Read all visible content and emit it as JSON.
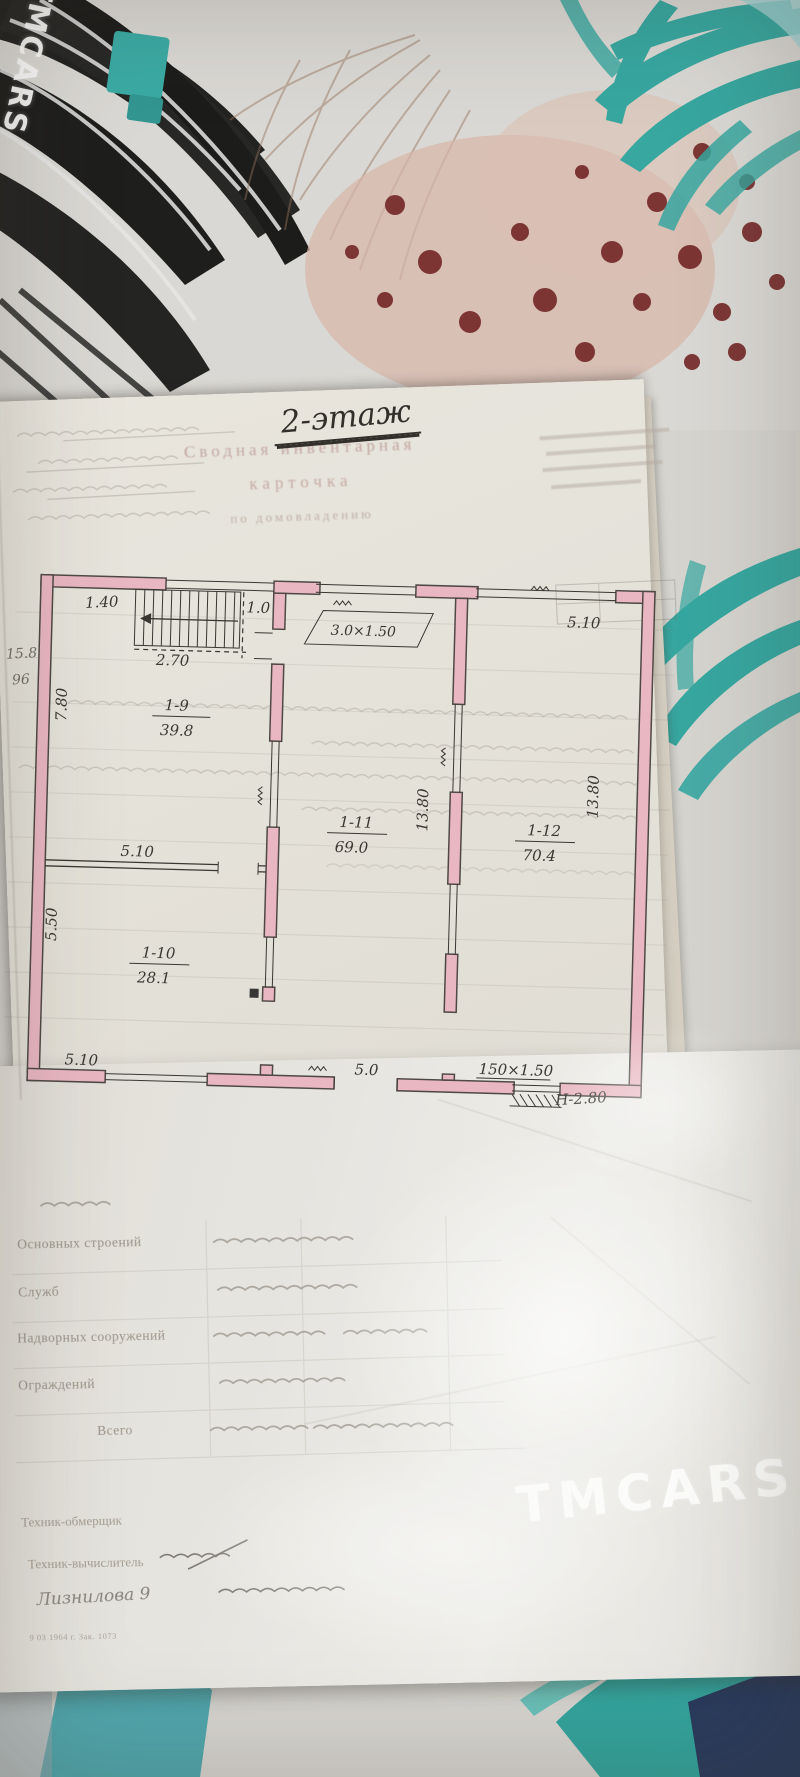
{
  "watermark": {
    "brand": "TMCARS"
  },
  "document": {
    "floor_note": "2-этаж",
    "title_line1": "Сводная инвентарная",
    "title_line2": "карточка",
    "subtitle": "по домовладению",
    "margin_note1": "15.8",
    "margin_note2": "96"
  },
  "plan": {
    "stairs": {
      "width": "1.40",
      "run": "2.70",
      "exit": "1.0"
    },
    "balcony_label": "3.0×1.50",
    "window_top_right": "5.10",
    "rooms": [
      {
        "number": "1-9",
        "area": "39.8"
      },
      {
        "number": "1-10",
        "area": "28.1"
      },
      {
        "number": "1-11",
        "area": "69.0"
      },
      {
        "number": "1-12",
        "area": "70.4"
      }
    ],
    "dims": {
      "left_upper": "7.80",
      "left_lower": "5.50",
      "partition": "5.10",
      "depth_mid": "13.80",
      "depth_right": "13.80",
      "bottom_left": "5.10",
      "bottom_mid": "5.0",
      "opening_size": "150×1.50",
      "ceiling_height": "Н-2.80"
    }
  },
  "form": {
    "rows": [
      "Основных строений",
      "Служб",
      "Надворных сооружений",
      "Ограждений",
      "Всего"
    ],
    "sign_row1": "Техник-обмерщик",
    "sign_row2": "Техник-вычислитель",
    "handwritten_name": "Лизнилова 9",
    "footer_note": "9 03 1964 г.   Зак. 1073"
  }
}
